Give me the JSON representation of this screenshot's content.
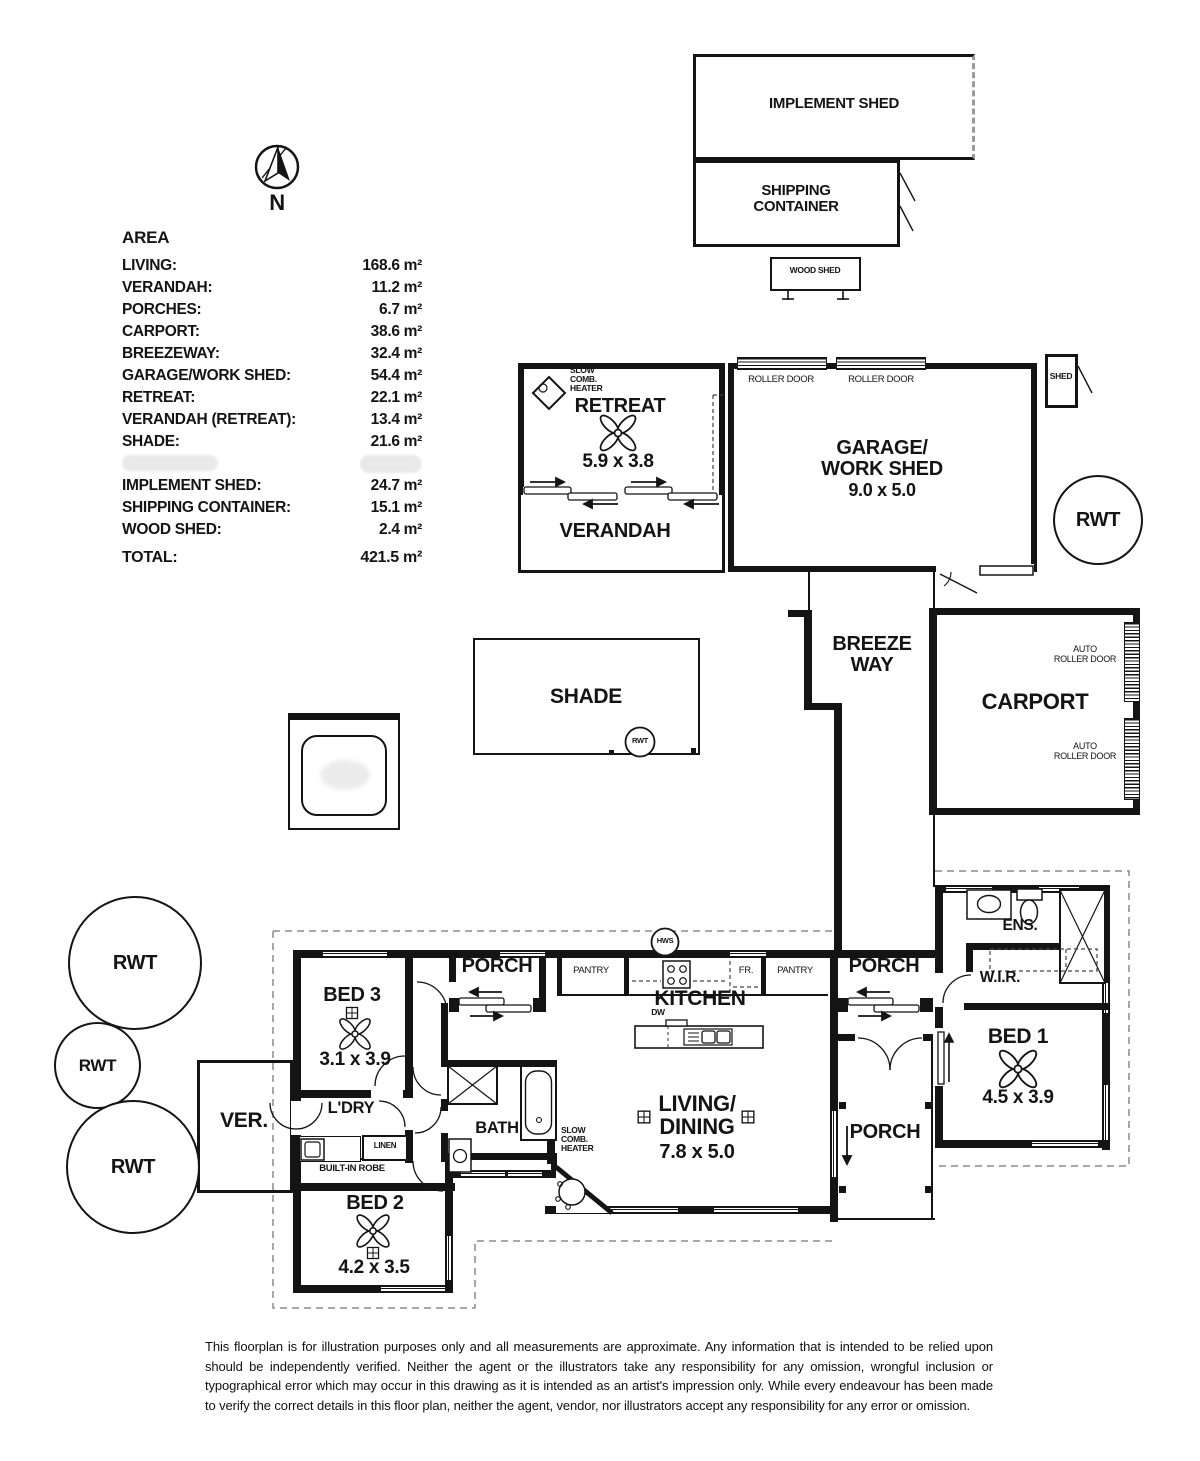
{
  "compass": {
    "north_label": "N"
  },
  "legend": {
    "title": "AREA",
    "rows": [
      {
        "label": "LIVING:",
        "value": "168.6 m²"
      },
      {
        "label": "VERANDAH:",
        "value": "11.2 m²"
      },
      {
        "label": "PORCHES:",
        "value": "6.7 m²"
      },
      {
        "label": "CARPORT:",
        "value": "38.6 m²"
      },
      {
        "label": "BREEZEWAY:",
        "value": "32.4 m²"
      },
      {
        "label": "GARAGE/WORK SHED:",
        "value": "54.4 m²"
      },
      {
        "label": "RETREAT:",
        "value": "22.1 m²"
      },
      {
        "label": "VERANDAH (RETREAT):",
        "value": "13.4 m²"
      },
      {
        "label": "SHADE:",
        "value": "21.6 m²"
      },
      {
        "label": "IMPLEMENT SHED:",
        "value": "24.7 m²"
      },
      {
        "label": "SHIPPING CONTAINER:",
        "value": "15.1 m²"
      },
      {
        "label": "WOOD SHED:",
        "value": "2.4 m²"
      }
    ],
    "total_label": "TOTAL:",
    "total_value": "421.5 m²"
  },
  "outbuildings": {
    "implement_shed": {
      "label": "IMPLEMENT SHED"
    },
    "shipping_container": {
      "label": "SHIPPING\nCONTAINER"
    },
    "wood_shed": {
      "label": "WOOD SHED"
    },
    "shed": {
      "label": "SHED"
    },
    "retreat": {
      "label": "RETREAT",
      "dims": "5.9 x 3.8",
      "heater_label": "SLOW\nCOMB.\nHEATER"
    },
    "verandah_retreat": {
      "label": "VERANDAH"
    },
    "garage": {
      "label": "GARAGE/\nWORK SHED",
      "dims": "9.0 x 5.0",
      "roller_door_left": "ROLLER DOOR",
      "roller_door_right": "ROLLER DOOR"
    },
    "breezeway": {
      "label": "BREEZE\nWAY"
    },
    "carport": {
      "label": "CARPORT",
      "auto_roller_door_top": "AUTO\nROLLER DOOR",
      "auto_roller_door_bottom": "AUTO\nROLLER DOOR"
    },
    "shade": {
      "label": "SHADE",
      "rwt_label": "RWT"
    }
  },
  "tanks": {
    "rwt_garage": "RWT",
    "rwt_left_top": "RWT",
    "rwt_left_mid": "RWT",
    "rwt_left_bottom": "RWT"
  },
  "house": {
    "bed1": {
      "label": "BED 1",
      "dims": "4.5 x 3.9"
    },
    "bed2": {
      "label": "BED 2",
      "dims": "4.2 x 3.5"
    },
    "bed3": {
      "label": "BED 3",
      "dims": "3.1 x 3.9"
    },
    "kitchen": {
      "label": "KITCHEN",
      "pantry_left": "PANTRY",
      "pantry_right": "PANTRY",
      "fridge": "FR.",
      "dishwasher": "DW",
      "hws": "HWS"
    },
    "living": {
      "label": "LIVING/\nDINING",
      "dims": "7.8 x 5.0",
      "heater_label": "SLOW\nCOMB.\nHEATER"
    },
    "laundry": {
      "label": "L'DRY",
      "linen": "LINEN",
      "robe": "BUILT-IN ROBE"
    },
    "bath": {
      "label": "BATH"
    },
    "ens": {
      "label": "ENS."
    },
    "wir": {
      "label": "W.I.R."
    },
    "porch_left": {
      "label": "PORCH"
    },
    "porch_top_right": {
      "label": "PORCH"
    },
    "porch_bottom_right": {
      "label": "PORCH"
    },
    "ver": {
      "label": "VER."
    }
  },
  "disclaimer": "This floorplan is for illustration purposes only and all measurements are approximate. Any information that is intended to be relied upon should be independently verified. Neither the agent or the illustrators take any responsibility for any omission, wrongful inclusion or typographical error which may occur in this drawing as it is intended as an artist's impression only. While every endeavour has been made to verify the correct details in this floor plan, neither the agent, vendor, nor illustrators accept any responsibility for any error or omission."
}
